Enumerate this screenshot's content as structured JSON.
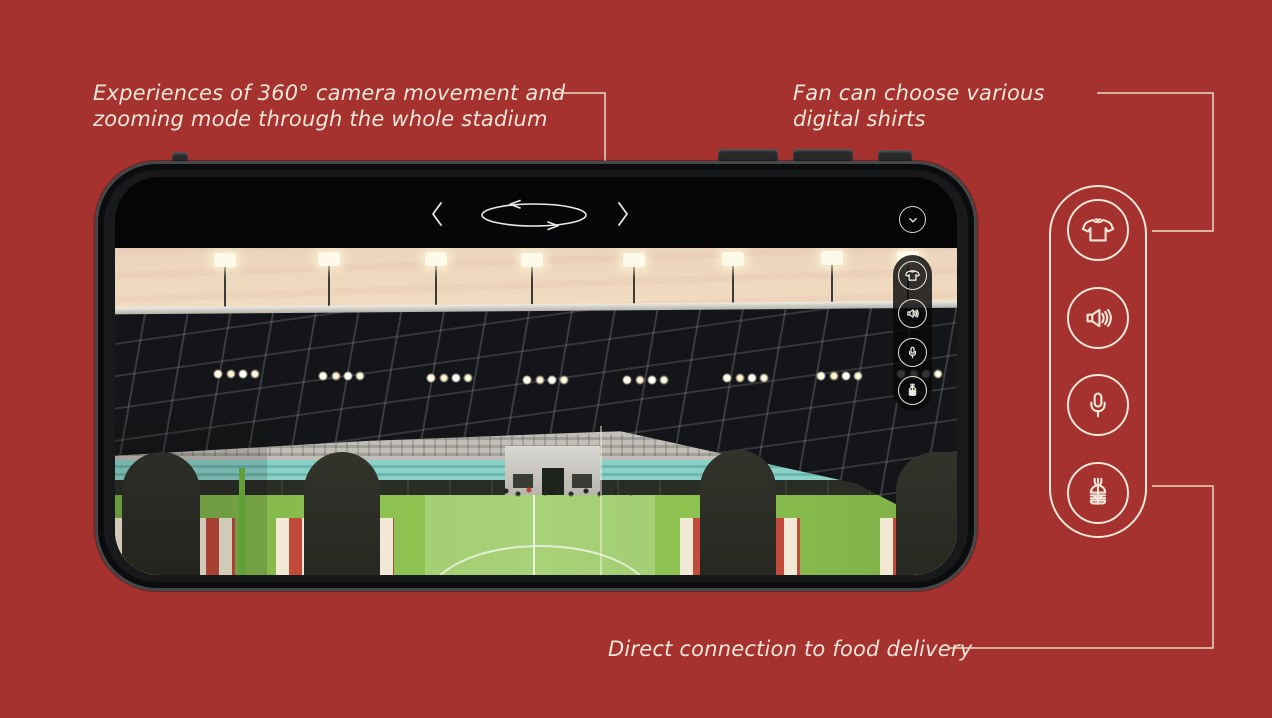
{
  "colors": {
    "background": "#a5322f",
    "accent_cream": "#f2e7d8",
    "phone_frame": "#17191b",
    "pitch_green": "#8dc251",
    "stripe_red": "#c14a3a",
    "teal_seats": "#7cc8be"
  },
  "annotations": {
    "camera": {
      "text": "Experiences of 360° camera movement and\nzooming mode through the whole stadium"
    },
    "shirts": {
      "text": "Fan can choose various\ndigital shirts"
    },
    "food": {
      "text": "Direct connection to food delivery"
    }
  },
  "phone": {
    "top_bar": {
      "icons": [
        "chevron-left",
        "rotate-360",
        "chevron-right"
      ]
    },
    "collapse_icon": "chevron-down",
    "screen_menu": {
      "items": [
        {
          "icon": "tshirt"
        },
        {
          "icon": "speaker"
        },
        {
          "icon": "microphone"
        },
        {
          "icon": "burger"
        }
      ]
    },
    "view": "stadium-360-panorama"
  },
  "side_panel": {
    "items": [
      {
        "icon": "tshirt"
      },
      {
        "icon": "speaker"
      },
      {
        "icon": "microphone"
      },
      {
        "icon": "burger"
      }
    ]
  }
}
